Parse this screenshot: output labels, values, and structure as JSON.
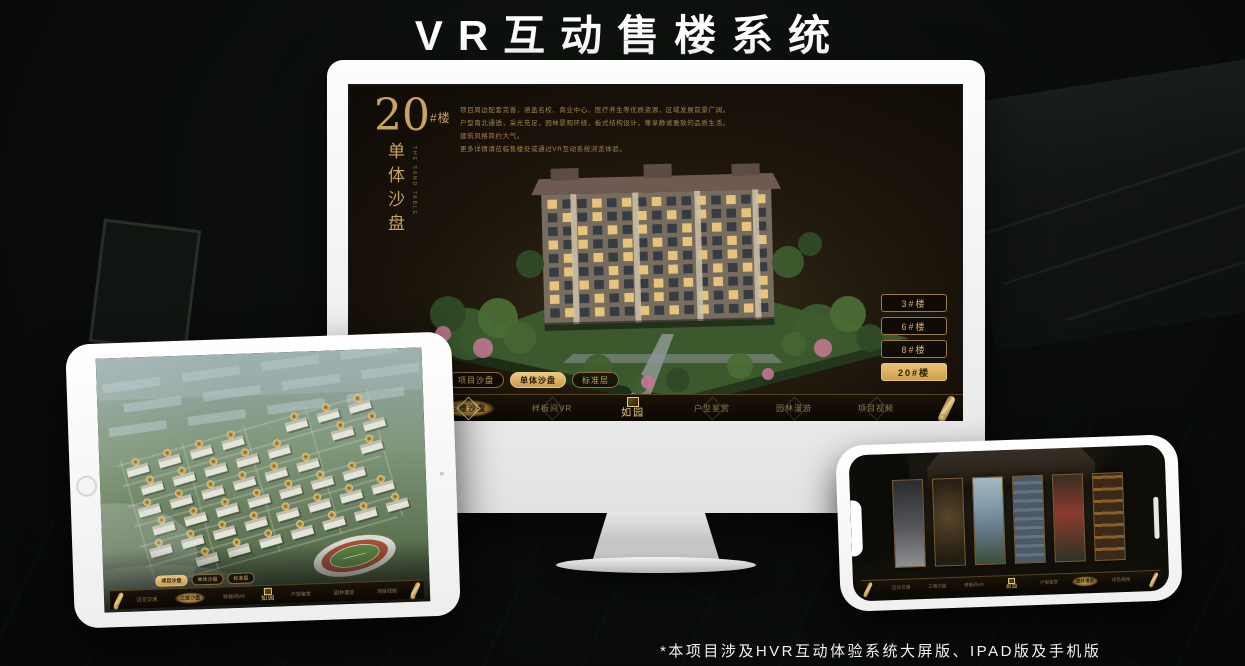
{
  "page": {
    "title": "VR互动售楼系统",
    "footnote": "*本项目涉及HVR互动体验系统大屏版、IPAD版及手机版"
  },
  "colors": {
    "gold": "#c9a35f",
    "gold_bright": "#e9cb83",
    "selected_text": "#2a1d0c",
    "screen_bg": "#1a130a"
  },
  "monitor": {
    "panel": {
      "big_number": "20",
      "number_suffix": "#楼",
      "vertical_title": "单体沙盘",
      "vertical_caption": "THE SAND TABLE",
      "description_lines": [
        "项目周边配套完善，涵盖名校、商业中心、医疗养生等优质资源，区域发展前景广阔。",
        "户型南北通透，采光充足，园林景观环绕，板式结构设计，尊享静谧雅致的品质生活。",
        "建筑风格简约大气。",
        "更多详情请莅临售楼处或通过VR互动系统浏览体验。"
      ]
    },
    "floor_buttons": [
      {
        "label": "3#楼",
        "selected": false
      },
      {
        "label": "6#楼",
        "selected": false
      },
      {
        "label": "8#楼",
        "selected": false
      },
      {
        "label": "20#楼",
        "selected": true
      }
    ],
    "sub_tabs": [
      {
        "label": "项目沙盘",
        "selected": false
      },
      {
        "label": "单体沙盘",
        "selected": true
      },
      {
        "label": "标准层",
        "selected": false
      }
    ],
    "nav": {
      "left_items": [
        {
          "label": "区位交通",
          "selected": false
        },
        {
          "label": "三维沙盘",
          "selected": true
        },
        {
          "label": "样板间VR",
          "selected": false
        }
      ],
      "logo_text": "如园",
      "right_items": [
        {
          "label": "户型鉴赏",
          "selected": false
        },
        {
          "label": "园林漫游",
          "selected": false
        },
        {
          "label": "项目视频",
          "selected": false
        }
      ]
    }
  },
  "tablet": {
    "sub_tabs": [
      {
        "label": "项目沙盘",
        "selected": true
      },
      {
        "label": "单体沙盘",
        "selected": false
      },
      {
        "label": "标准层",
        "selected": false
      }
    ],
    "nav": {
      "left_items": [
        {
          "label": "区位交通",
          "selected": false
        },
        {
          "label": "三维沙盘",
          "selected": true
        },
        {
          "label": "样板间VR",
          "selected": false
        }
      ],
      "logo_text": "如园",
      "right_items": [
        {
          "label": "户型鉴赏",
          "selected": false
        },
        {
          "label": "园林漫游",
          "selected": false
        },
        {
          "label": "项目视频",
          "selected": false
        }
      ]
    }
  },
  "phone": {
    "nav": {
      "left_items": [
        {
          "label": "区位交通",
          "selected": false
        },
        {
          "label": "三维沙盘",
          "selected": false
        },
        {
          "label": "样板间VR",
          "selected": false
        }
      ],
      "logo_text": "如园",
      "right_items": [
        {
          "label": "户型鉴赏",
          "selected": false
        },
        {
          "label": "园林漫游",
          "selected": true
        },
        {
          "label": "项目视频",
          "selected": false
        }
      ]
    }
  }
}
